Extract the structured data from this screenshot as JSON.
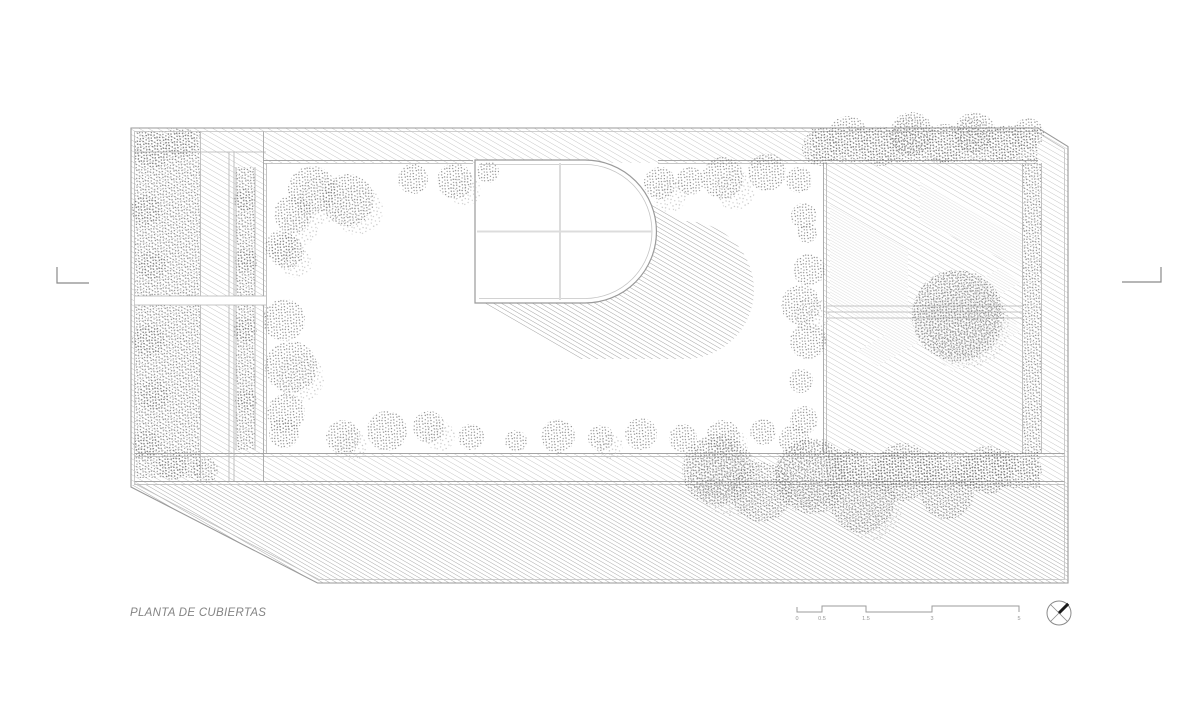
{
  "plan_label": "PLANTA DE CUBIERTAS",
  "scale_bar": {
    "labels": [
      "0",
      "0.5",
      "1.5",
      "3",
      "5"
    ]
  },
  "north_arrow": {
    "icon": "circle-cross-north-arrow"
  },
  "colors": {
    "background": "#ffffff",
    "outline": "#9a9a9a",
    "hatch_light": "#c2c2c2",
    "hatch_dark": "#a9a9a9",
    "stipple": "#7a7a7a",
    "title_text": "#848484",
    "north_accent": "#1a1a1a"
  }
}
